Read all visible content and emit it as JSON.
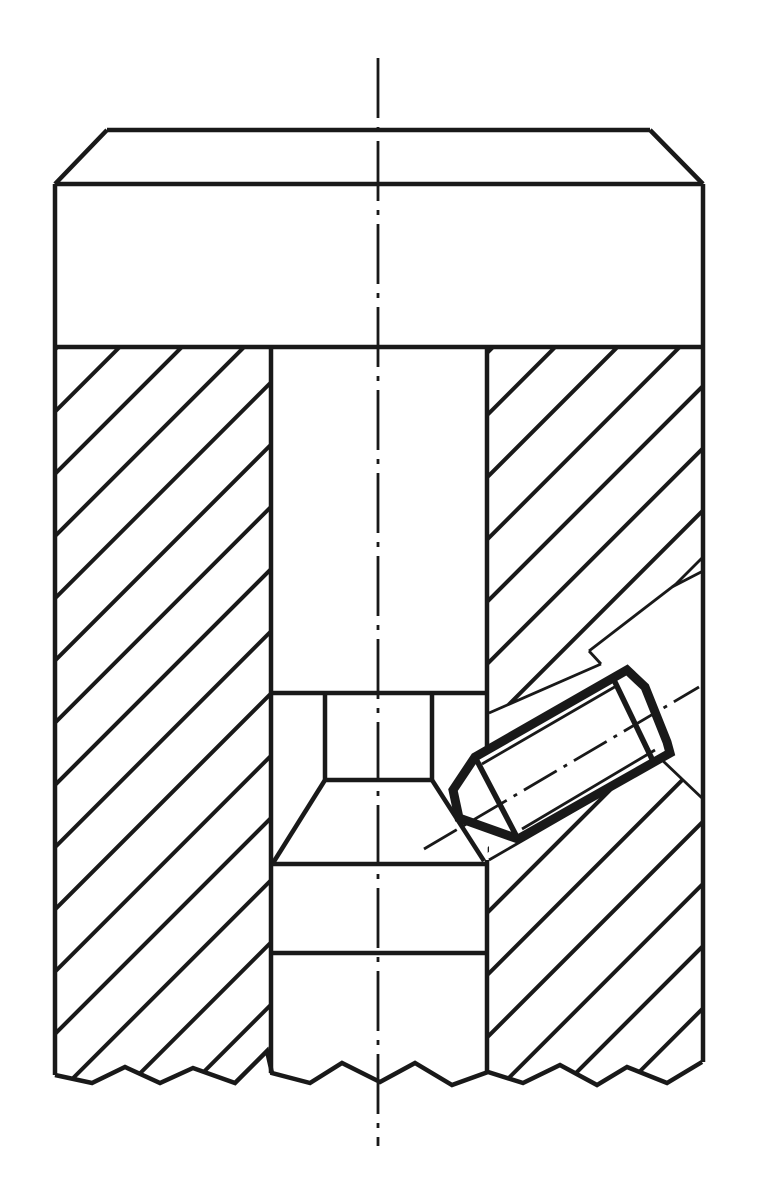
{
  "drawing": {
    "description": "sectional-engineering-drawing-set-screw-assembly",
    "canvas": {
      "width": 762,
      "height": 1200,
      "background": "#ffffff",
      "line_color": "#191919"
    },
    "strokes": {
      "outline": 4.5,
      "thin": 2.8,
      "bold": 9,
      "inner_bold": 5.5,
      "center": 2.8,
      "hatch": 4
    },
    "hatch": {
      "angle_deg": 45,
      "perpendicular_spacing": 44
    },
    "hatch_regions": [
      {
        "name": "hatch-left-wall",
        "d": "M55,347 L271,347 L272,1073 L267,1051 L235,1083 L193,1068 L160,1083 L125,1067 L92,1083 L55,1075 Z",
        "fill_rule": "nonzero"
      },
      {
        "name": "hatch-right-wall",
        "d": "M487,347 L703,347 L703,1062 L667,1083 L627,1067 L597,1085 L560,1065 L523,1083 L488,1072 Z M489,713 L601,664 L589,651 L676,584 L703,557 L703,799 L662,760 L489,860 Z",
        "fill_rule": "evenodd"
      }
    ],
    "outline_lines": [
      {
        "name": "head-top-edge",
        "x1": 107,
        "y1": 130,
        "x2": 650,
        "y2": 130
      },
      {
        "name": "head-chamfer-left",
        "x1": 107,
        "y1": 130,
        "x2": 55,
        "y2": 184
      },
      {
        "name": "head-chamfer-right",
        "x1": 650,
        "y1": 130,
        "x2": 703,
        "y2": 184
      },
      {
        "name": "head-shoulder-line",
        "x1": 55,
        "y1": 184,
        "x2": 703,
        "y2": 184
      },
      {
        "name": "body-left-edge",
        "x1": 55,
        "y1": 184,
        "x2": 55,
        "y2": 1075
      },
      {
        "name": "body-right-edge",
        "x1": 703,
        "y1": 184,
        "x2": 703,
        "y2": 1062
      },
      {
        "name": "head-bottom-line",
        "x1": 55,
        "y1": 347,
        "x2": 703,
        "y2": 347
      },
      {
        "name": "bore-left-wall",
        "x1": 271,
        "y1": 347,
        "x2": 271,
        "y2": 1073
      },
      {
        "name": "bore-right-wall-upper",
        "x1": 487,
        "y1": 347,
        "x2": 487,
        "y2": 749
      },
      {
        "name": "bore-right-wall-lower",
        "x1": 487,
        "y1": 860,
        "x2": 487,
        "y2": 1072
      },
      {
        "name": "pin-step-line-top",
        "x1": 271,
        "y1": 693,
        "x2": 487,
        "y2": 693
      },
      {
        "name": "pin-neck-left",
        "x1": 325,
        "y1": 693,
        "x2": 325,
        "y2": 780
      },
      {
        "name": "pin-neck-right",
        "x1": 432,
        "y1": 693,
        "x2": 432,
        "y2": 780
      },
      {
        "name": "pin-neck-bottom",
        "x1": 325,
        "y1": 780,
        "x2": 432,
        "y2": 780
      },
      {
        "name": "pin-cone-flank-left",
        "x1": 325,
        "y1": 780,
        "x2": 273,
        "y2": 863
      },
      {
        "name": "pin-cone-flank-right",
        "x1": 432,
        "y1": 780,
        "x2": 484,
        "y2": 861
      },
      {
        "name": "pin-step-line-middle",
        "x1": 271,
        "y1": 864,
        "x2": 487,
        "y2": 864
      },
      {
        "name": "pin-step-line-lower",
        "x1": 271,
        "y1": 953,
        "x2": 487,
        "y2": 953
      }
    ],
    "break_line": {
      "name": "break-line-zigzag",
      "points": "55,1075 92,1083 125,1067 160,1083 193,1068 235,1083 267,1051 272,1073 310,1083 342,1063 380,1082 415,1063 452,1085 488,1072 523,1083 560,1065 597,1085 627,1067 667,1083 702,1062"
    },
    "hole_lines": [
      {
        "name": "screw-hole-upper-edge",
        "x1": 489,
        "y1": 713,
        "x2": 601,
        "y2": 664
      },
      {
        "name": "screw-hole-upper-step",
        "x1": 601,
        "y1": 664,
        "x2": 589,
        "y2": 651
      },
      {
        "name": "screw-hole-counterbore-top",
        "x1": 589,
        "y1": 651,
        "x2": 676,
        "y2": 584
      },
      {
        "name": "screw-hole-mouth-chamfer-1",
        "x1": 703,
        "y1": 557,
        "x2": 676,
        "y2": 584
      },
      {
        "name": "screw-hole-mouth-chamfer-2",
        "x1": 703,
        "y1": 571,
        "x2": 672,
        "y2": 587
      },
      {
        "name": "screw-hole-lower-edge",
        "x1": 489,
        "y1": 860,
        "x2": 662,
        "y2": 760
      },
      {
        "name": "screw-hole-counterbore-bot",
        "x1": 662,
        "y1": 760,
        "x2": 703,
        "y2": 799
      }
    ],
    "set_screw": {
      "name": "set-screw-body",
      "outline_points": "475,757 627,670 645,687 667,742 670,753 518,839 459,818 453,790",
      "inner_bold_lines": [
        {
          "name": "set-screw-cone-base-line",
          "x1": 475,
          "y1": 757,
          "x2": 518,
          "y2": 839
        },
        {
          "name": "set-screw-chamfer-base-line",
          "x1": 613,
          "y1": 678,
          "x2": 653,
          "y2": 761
        }
      ],
      "thread_lines": [
        {
          "name": "set-screw-thread-line-top",
          "x1": 482,
          "y1": 764,
          "x2": 618,
          "y2": 685
        },
        {
          "name": "set-screw-thread-line-bottom",
          "x1": 522,
          "y1": 829,
          "x2": 655,
          "y2": 750
        }
      ]
    },
    "centerlines": [
      {
        "name": "centerline-vertical",
        "x1": 378,
        "y1": 58,
        "x2": 378,
        "y2": 1146,
        "dash": "60 9 5 9"
      },
      {
        "name": "centerline-screw-axis",
        "x1": 424,
        "y1": 849,
        "x2": 699,
        "y2": 687,
        "dash": "38 8 4 8"
      }
    ]
  }
}
